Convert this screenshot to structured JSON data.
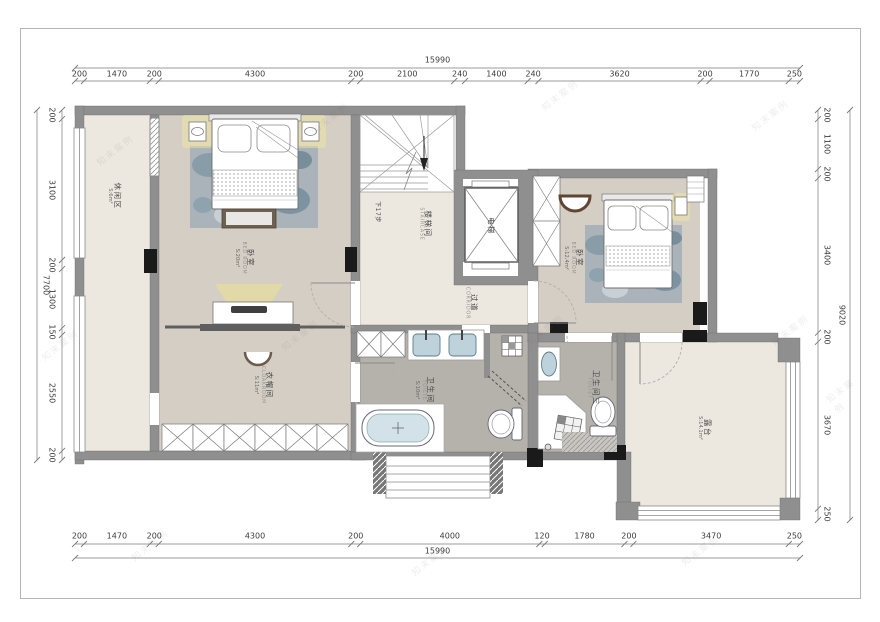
{
  "page": {
    "background": "#ffffff",
    "border_color": "#b5b5b5"
  },
  "watermark": {
    "text": "知末案例"
  },
  "dimensions": {
    "top": {
      "total": "15990",
      "segments": [
        "200",
        "1470",
        "200",
        "4300",
        "200",
        "2100",
        "240",
        "1400",
        "240",
        "3620",
        "200",
        "1770",
        "250"
      ]
    },
    "bottom": {
      "total": "15990",
      "segments": [
        "200",
        "1470",
        "200",
        "4300",
        "200",
        "4000",
        "120",
        "1780",
        "200",
        "3470",
        "250"
      ]
    },
    "left": {
      "total": "7700",
      "segments": [
        "200",
        "3100",
        "200",
        "1300",
        "150",
        "2550",
        "200"
      ]
    },
    "right": {
      "total": "9020",
      "segments": [
        "200",
        "1100",
        "200",
        "3400",
        "200",
        "3670",
        "250"
      ]
    }
  },
  "rooms": {
    "leisure": {
      "name_zh": "休闲区",
      "area": "S:6m²"
    },
    "bedroom_master": {
      "name_zh": "卧室",
      "name_en": "BED ROOM",
      "area": "S:20m²"
    },
    "staircase": {
      "name_zh": "楼梯间",
      "name_en": "STAIRCASE"
    },
    "stair_note": {
      "name_zh": "下17步"
    },
    "elevator": {
      "name_zh": "电梯"
    },
    "corridor": {
      "name_zh": "过道",
      "name_en": "CORRIDOR"
    },
    "bedroom_second": {
      "name_zh": "卧室",
      "name_en": "BED ROOM",
      "area": "S:12.4m²"
    },
    "cloakroom": {
      "name_zh": "衣帽间",
      "name_en": "CLOAKROOM",
      "area": "S:11m²"
    },
    "bathroom_main": {
      "name_zh": "卫生间",
      "name_en": "TOILTE",
      "area": "S:10m²"
    },
    "bathroom_third": {
      "name_zh": "卫生间三",
      "name_en": "TOLIET"
    },
    "terrace": {
      "name_zh": "露台",
      "area": "S:14.1m²"
    }
  },
  "colors": {
    "wall": "#8f8f8f",
    "floor_light": "#ece8df",
    "floor_warm": "#d5cec5",
    "floor_bath": "#b5b1ab",
    "glow": "#f0e5a0",
    "water": "#bdd2da",
    "column": "#1a1a1a"
  }
}
